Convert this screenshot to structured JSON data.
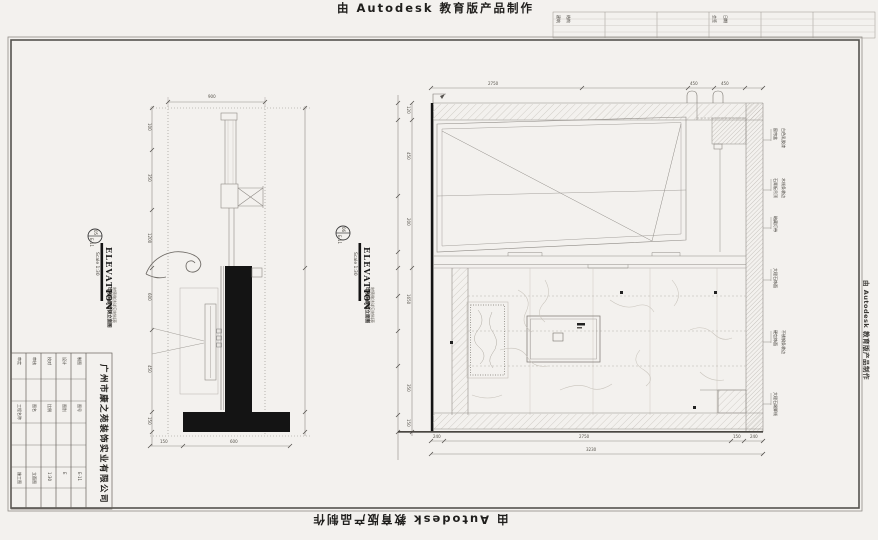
{
  "watermark": {
    "top": "由 Autodesk 教育版产品制作",
    "bottom": "由 Autodesk 教育版产品制作",
    "side": "由 Autodesk 教育版产品制作"
  },
  "top_strip": {
    "c1a": "建筑",
    "c1b": "结构",
    "c2a": "会签",
    "c2b": "日期"
  },
  "title_block": {
    "company": "广州市康之苑装饰实业有限公司",
    "row1": [
      "审定",
      "审核",
      "校对",
      "设计",
      "制图"
    ],
    "row2": [
      "工程名称",
      "图名",
      "比例",
      "图别",
      "图号"
    ],
    "row3": [
      "施工图",
      "立面图",
      "1:30",
      "E",
      "E-11"
    ]
  },
  "left_view": {
    "callout_no": "05",
    "callout_sheet": "E-11",
    "title": "ELEVATION",
    "scale": "Scale 1:30",
    "caption": "电视背景墙侧立面图",
    "caption2": "材质做法详见材料表",
    "dim_top": "900",
    "dims_left": [
      "100",
      "350",
      "1200",
      "600",
      "450",
      "150"
    ],
    "dims_bottom": [
      "150",
      "600"
    ]
  },
  "right_view": {
    "callout_no": "06",
    "callout_sheet": "E-11",
    "title": "ELEVATION",
    "scale": "Scale 1:30",
    "caption": "电视背景墙立面图",
    "caption2": "材质做法详见材料表",
    "dims_top": [
      "2750",
      "450",
      "450"
    ],
    "dims_left": [
      "120",
      "450",
      "200",
      "1650",
      "350",
      "150"
    ],
    "dims_bottom": [
      "240",
      "2750",
      "150",
      "240"
    ],
    "dim_total": "3230",
    "annotations": [
      {
        "a": "窗帘盒",
        "b": "白色乳胶漆"
      },
      {
        "a": "石膏板吊顶",
        "b": "木线条收边"
      },
      {
        "a": "暗藏灯带",
        "b": ""
      },
      {
        "a": "大理石饰面",
        "b": ""
      },
      {
        "a": "硬包饰面",
        "b": "不锈钢条收边"
      },
      {
        "a": "大理石踢脚线",
        "b": ""
      }
    ]
  }
}
